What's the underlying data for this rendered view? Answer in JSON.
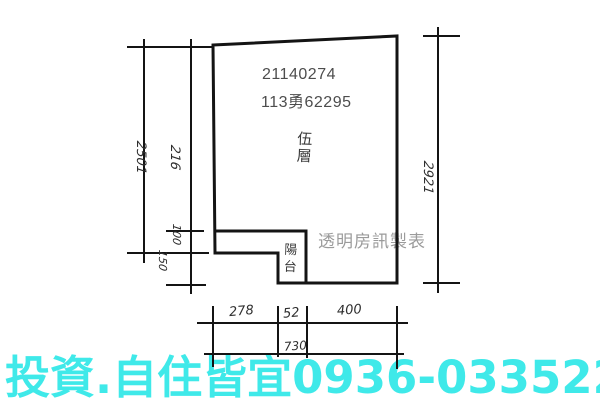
{
  "plan": {
    "ids": {
      "case_number": "21140274",
      "ref_number": "113勇62295"
    },
    "labels": {
      "floor": "伍層",
      "balcony": "陽台",
      "maker_watermark": "透明房訊製表"
    },
    "dimensions": {
      "left_total": "2501",
      "left_upper": "216",
      "left_mid": "100",
      "left_lower": "150",
      "right_height": "2921",
      "bottom_segments": [
        "278",
        "52",
        "400"
      ],
      "bottom_total": "730"
    },
    "line_color": "#141414"
  },
  "footer": {
    "ad_text": "投資.自住皆宜0936-033522",
    "ad_color": "#3fe9e9"
  }
}
